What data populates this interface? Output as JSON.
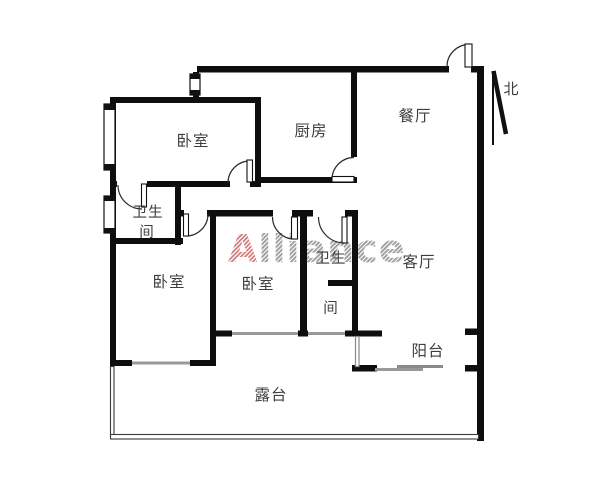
{
  "plan": {
    "watermark": {
      "lead": "A",
      "rest": "lliance",
      "lead_color": "#d47878",
      "rest_color": "#9e9e9e"
    },
    "compass": {
      "label": "北"
    },
    "rooms": {
      "bedroom_top": {
        "label": "卧室"
      },
      "kitchen": {
        "label": "厨房"
      },
      "dining": {
        "label": "餐厅"
      },
      "bathroom_left": {
        "line1": "卫生",
        "line2": "间"
      },
      "bedroom_left": {
        "label": "卧室"
      },
      "bedroom_middle": {
        "label": "卧室"
      },
      "bathroom_inner": {
        "line1": "卫生",
        "line2": "间"
      },
      "living": {
        "label": "客厅"
      },
      "balcony": {
        "label": "阳台"
      },
      "terrace": {
        "label": "露台"
      }
    },
    "colors": {
      "wall": "#0e0e0e",
      "label_text": "#3d3d3d",
      "window_gray": "#999999",
      "watermark_red": "#d47878",
      "watermark_gray": "#9e9e9e"
    }
  }
}
